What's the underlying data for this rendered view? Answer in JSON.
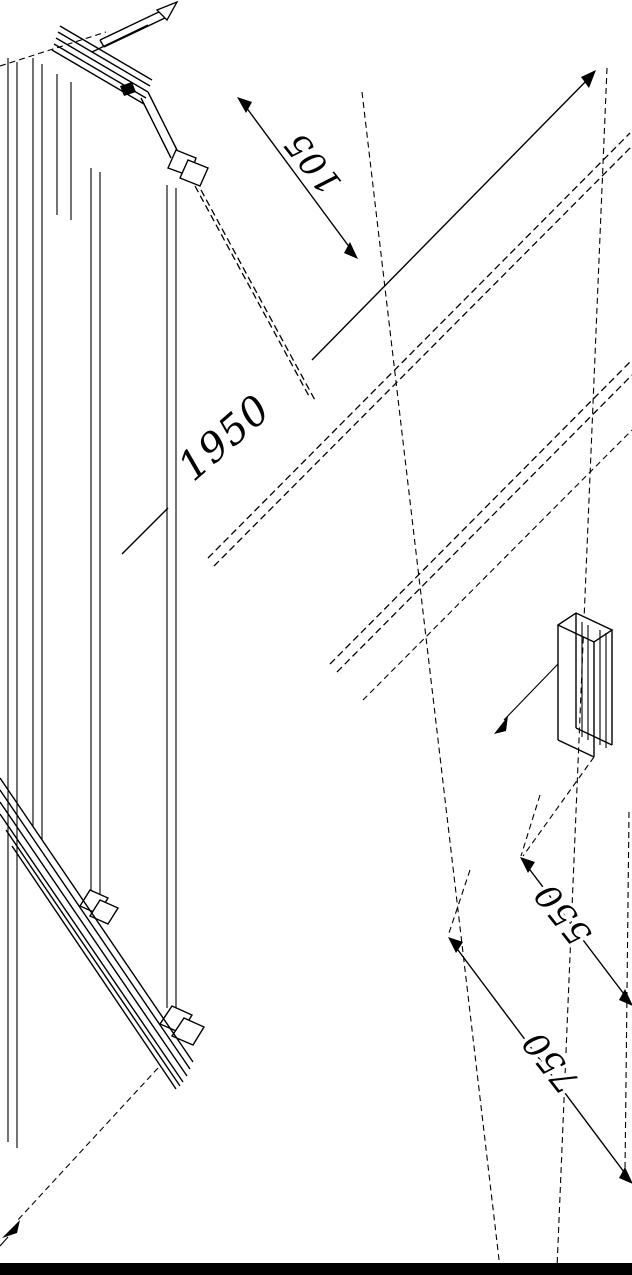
{
  "drawing": {
    "description": "Isometric technical line drawing of a walk-in glass shower screen with wall profile, hinged clamps, support bar and return panel bracket",
    "dimensions": {
      "top_offset": {
        "label": "105"
      },
      "height": {
        "label": "1950"
      },
      "inner_width": {
        "label": "550"
      },
      "outer_width": {
        "label": "750"
      }
    },
    "colors": {
      "stroke": "#000000",
      "background": "#ffffff",
      "footer_bar": "#000000"
    }
  }
}
